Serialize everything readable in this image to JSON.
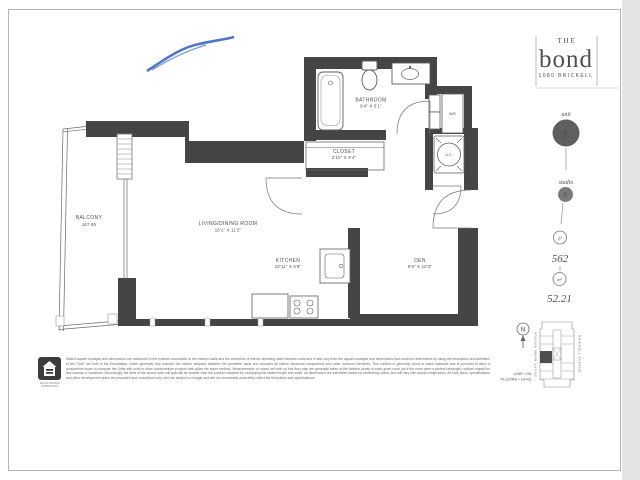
{
  "branding": {
    "the": "THE",
    "name": "bond",
    "address": "1080 BRICKELL"
  },
  "unit_info": {
    "unit_label": "unit",
    "unit_value": "F",
    "type_label": "studio",
    "type_value": "S",
    "area_sqft_unit": "ft²",
    "area_sqft": "562",
    "area_sqm_unit": "m²",
    "area_sqm": "52.21"
  },
  "rooms": {
    "bathroom": {
      "name": "BATHROOM",
      "dims": "9'4\" X 5'1\""
    },
    "closet": {
      "name": "CLOSET",
      "dims": "2'10\" X 9'4\""
    },
    "living": {
      "name": "LIVING/DINING ROOM",
      "dims": "10'1\" X 11'2\""
    },
    "kitchen": {
      "name": "KITCHEN",
      "dims": "10'11\" X 6'8\""
    },
    "den": {
      "name": "DEN",
      "dims": "9'8\" X 10'3\""
    },
    "balcony": {
      "name": "BALCONY",
      "dims": "167.85"
    }
  },
  "fixtures": {
    "washer_dryer": "W/D",
    "ac": "A.C."
  },
  "keyplan": {
    "north": "N",
    "line": "LINE • 05",
    "floors": "FLOORS • 14-43",
    "street_left": "SOUTH MIAMI AVENUE",
    "street_right": "BRICKELL AVENUE"
  },
  "footer": {
    "disclaimer": "Stated square footages and dimensions are measured to the exterior boundaries of the exterior walls and the centerline of interior demising walls between units and in fact vary from the square footages and dimensions that would be determined by using the description and definition of the \"Unit\" set forth in the Declaration, which generally only includes the interior airspace between the perimeter walls and excludes all interior structural components and other common elements. This method is generally found in sales materials and is provided to allow a prospective buyer to compare the Units with units in other condominium projects that utilize the same method. Measurements of rooms set forth on this floor plan are generally taken at the farthest points of each given room (as if the room were a perfect rectangle), without regard for any cutouts or variances. Accordingly, the area of the actual room will typically be smaller than the product obtained by multiplying the stated length and width. All dimensions are estimates based on preliminary plans, and will vary with actual construction. All floor plans, specifications and other development plans are proposed and conceptual only, and are subject to change and will not necessarily accurately reflect the final plans and specifications.",
    "equal_housing_line1": "EQUAL HOUSING",
    "equal_housing_line2": "OPPORTUNITY"
  },
  "colors": {
    "wall": "#454545",
    "ink": "#4f4f4f",
    "unit_circle": "#5f5f5f",
    "pen_mark": "#3f66c0",
    "page_border": "#b5b5b5"
  }
}
